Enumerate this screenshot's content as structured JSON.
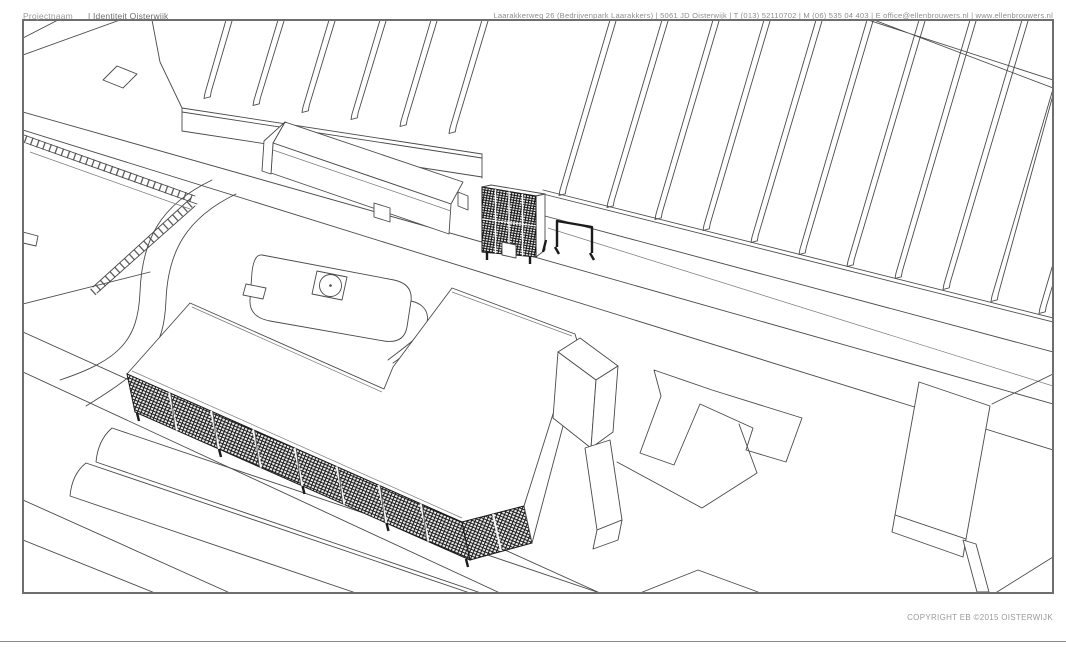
{
  "sheet": {
    "copyright": "COPYRIGHT EB ©2015 OISTERWIJK",
    "footer": {
      "project_label": "Projectnaam",
      "project_value": "| Identiteit Oisterwijk",
      "contact_line": "Laarakkerweg 26 (Bedrijvenpark Laarakkers) | 5061 JD Oisterwijk | T (013) 52110702 | M (06) 535 04 403 | E office@ellenbrouwers.nl | www.ellenbrouwers.nl"
    },
    "colors": {
      "line": "#4a4a4a",
      "frame": "#6e6e6e",
      "facade_dark": "#1b1b1b",
      "text_muted": "#9a9a9a"
    }
  }
}
